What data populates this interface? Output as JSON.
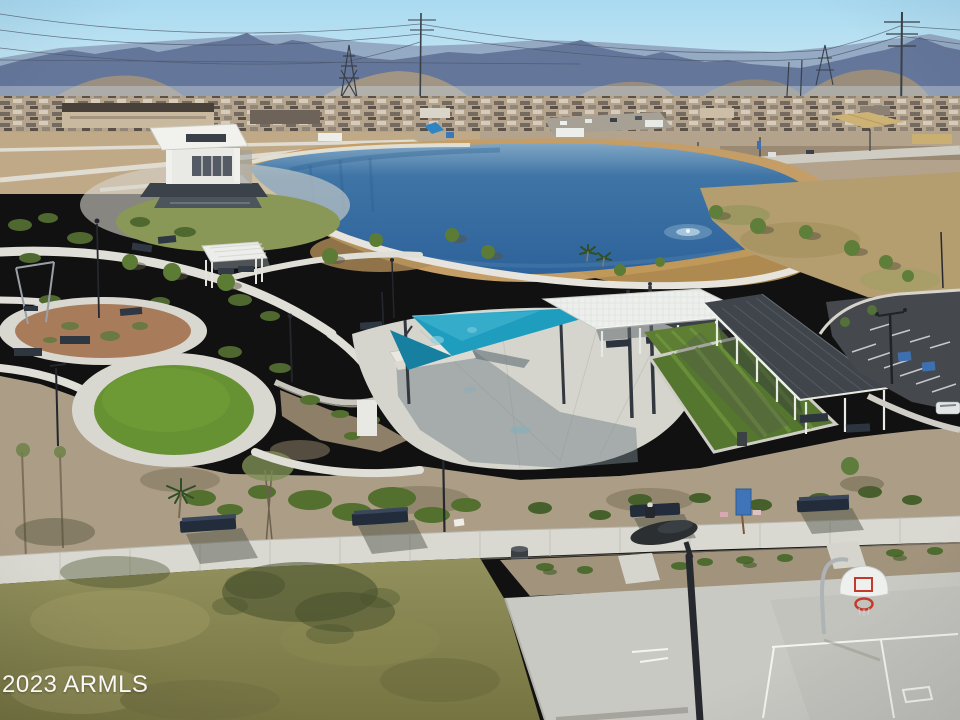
{
  "image": {
    "kind": "aerial photograph",
    "scene": "Desert community park with pond, amphitheater stage, teal shade sails, picnic ramadas, turf event lawns, parking lot and basketball court; mountains, power lines and new housing on the horizon",
    "width_px": 960,
    "height_px": 720
  },
  "watermark": {
    "text": "2023 ARMLS",
    "color": "#ffffff",
    "position": "bottom-left"
  },
  "palette": {
    "sky_top": "#aeddf2",
    "sky_horizon": "#dcedf3",
    "mountain_blue": "#64769a",
    "mountain_haze": "#c6d0da",
    "lake_deep": "#2e639b",
    "lake_light": "#7fa6c4",
    "shoreline_sand": "#c49e66",
    "park_lawn_green": "#8a9857",
    "turf_circle_green": "#679233",
    "desert_gravel": "#ab9d86",
    "dg_plaza_brown": "#a87c5a",
    "concrete_path": "#dad9d1",
    "shade_sail_teal": "#1f9dbe",
    "pavilion_white": "#edefec",
    "solar_ramada_roof": "#40454c",
    "parking_asphalt": "#45484c",
    "handicap_stall_blue": "#3e6fae",
    "court_concrete": "#c9c9c3",
    "court_line_white": "#f4f4f0",
    "hoop_rim_red": "#c4392c",
    "bench_navy": "#2c343e",
    "bottom_grass_olive": "#85834f",
    "shrub_green": "#53702f",
    "info_sign_blue": "#3f74b8"
  },
  "scene_elements": [
    "mountain range",
    "power transmission towers and lines",
    "housing rooftops",
    "dirt fields and roads with vehicles",
    "kidney-shaped pond with fountain ripple",
    "amphitheater stage with white canopy",
    "event lawn",
    "white pergola with picnic tables",
    "decomposed-granite circle",
    "artificial turf circle",
    "teal triangular shade sails on masts",
    "white picnic pavilion",
    "long solar-panel shade ramada",
    "green turf panels",
    "asphalt parking lot with accessible stalls",
    "desert gravel landscaping with shrubs",
    "concrete sidewalk with navy benches and a seated person",
    "blue information sign",
    "trash can",
    "olive grass lawn with tree shadows",
    "basketball court with hoop",
    "foreground street lamp"
  ]
}
